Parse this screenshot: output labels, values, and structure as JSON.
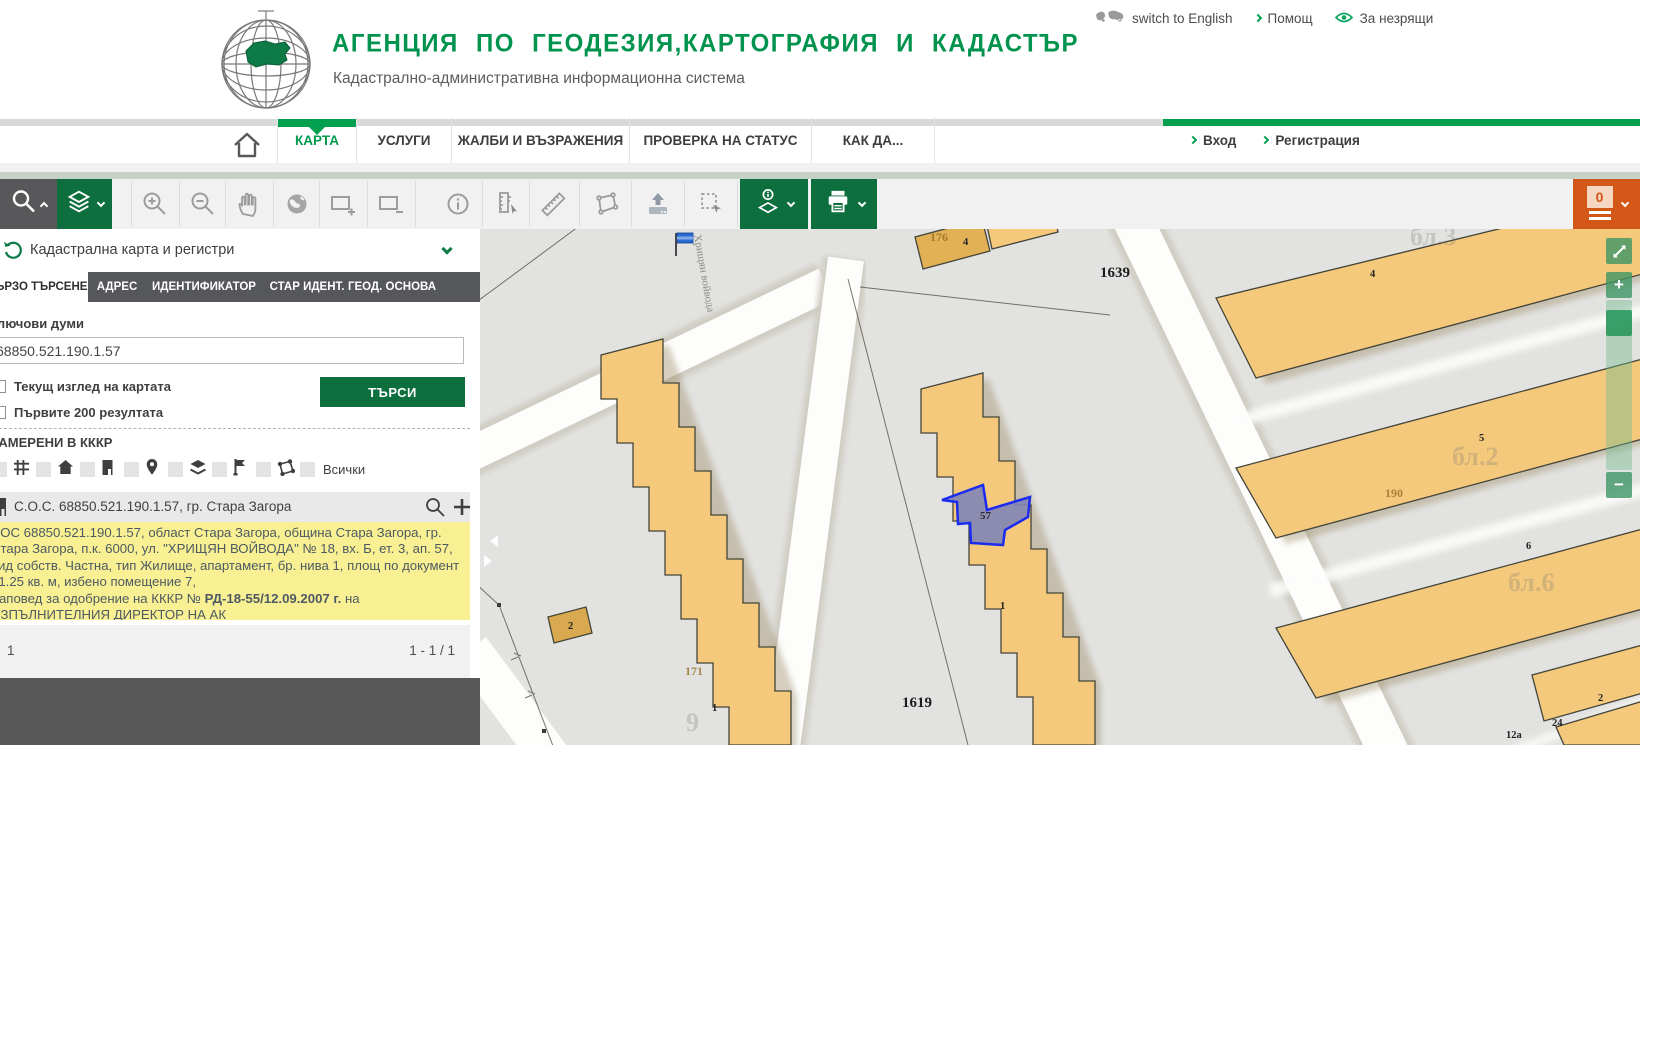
{
  "header": {
    "title": "АГЕНЦИЯ ПО ГЕОДЕЗИЯ,КАРТОГРАФИЯ И КАДАСТЪР",
    "subtitle": "Кадастрално-административна информационна система",
    "links": {
      "language": "switch to English",
      "help": "Помощ",
      "accessibility": "За незрящи"
    }
  },
  "nav": {
    "items": [
      {
        "label": "КАРТА",
        "active": true
      },
      {
        "label": "УСЛУГИ",
        "active": false
      },
      {
        "label": "ЖАЛБИ И ВЪЗРАЖЕНИЯ",
        "active": false
      },
      {
        "label": "ПРОВЕРКА НА СТАТУС",
        "active": false
      },
      {
        "label": "КАК ДА...",
        "active": false
      }
    ],
    "auth": {
      "login": "Вход",
      "register": "Регистрация"
    }
  },
  "toolbar": {
    "cart_count": "0"
  },
  "sidebar": {
    "panel_title": "Кадастрална карта и регистри",
    "tabs": [
      "БЪРЗО ТЪРСЕНЕ",
      "АДРЕС",
      "ИДЕНТИФИКАТОР",
      "СТАР ИДЕНТ.",
      "ГЕОД. ОСНОВА"
    ],
    "active_tab": "БЪРЗО ТЪРСЕНЕ",
    "keywords_label": "Ключови думи",
    "search_value": "68850.521.190.1.57",
    "option_current_view": "Текущ изглед на картата",
    "option_first_200": "Първите 200 резултата",
    "search_button": "ТЪРСИ",
    "results_header": "НАМЕРЕНИ В КККР",
    "filter_all_label": "Всички",
    "result_title": "С.О.С. 68850.521.190.1.57, гр. Стара Загора",
    "result_details_1": "СОС 68850.521.190.1.57, област Стара Загора, община Стара Загора, гр. Стара Загора, п.к. 6000, ул. \"ХРИЩЯН ВОЙВОДА\" № 18, вх. Б, ет. 3, ап. 57, вид собств. Частна, тип Жилище, апартамент, бр. нива 1, площ по документ 61.25 кв. м, избено помещение 7,",
    "result_details_2_prefix": "Заповед за одобрение на КККР № ",
    "result_details_2_bold": "РД-18-55/12.09.2007 г.",
    "result_details_2_suffix": " на ИЗПЪЛНИТЕЛНИЯ ДИРЕКТОР НА АК",
    "page_number": "1",
    "page_range": "1 - 1 / 1"
  },
  "map": {
    "street_label": "Хрищян войвода",
    "selected_parcel_label": "57",
    "zoom_in_glyph": "+",
    "zoom_out_glyph": "−",
    "labels": [
      {
        "text": "176",
        "x": 450,
        "y": 12,
        "cls": "tan-num"
      },
      {
        "text": "4",
        "x": 483,
        "y": 16,
        "cls": "bldg-num"
      },
      {
        "text": "1639",
        "x": 620,
        "y": 48,
        "cls": "parcel-num"
      },
      {
        "text": "бл.3",
        "x": 930,
        "y": 16,
        "cls": "faint"
      },
      {
        "text": "4",
        "x": 890,
        "y": 48,
        "cls": "bldg-num"
      },
      {
        "text": "5",
        "x": 999,
        "y": 212,
        "cls": "bldg-num"
      },
      {
        "text": "бл.2",
        "x": 972,
        "y": 236,
        "cls": "faint"
      },
      {
        "text": "190",
        "x": 905,
        "y": 268,
        "cls": "tan-num"
      },
      {
        "text": "6",
        "x": 1046,
        "y": 320,
        "cls": "bldg-num"
      },
      {
        "text": "бл.6",
        "x": 1028,
        "y": 362,
        "cls": "faint"
      },
      {
        "text": "1",
        "x": 520,
        "y": 380,
        "cls": "bldg-num"
      },
      {
        "text": "1619",
        "x": 422,
        "y": 478,
        "cls": "parcel-num"
      },
      {
        "text": "2",
        "x": 88,
        "y": 400,
        "cls": "bldg-num"
      },
      {
        "text": "171",
        "x": 205,
        "y": 446,
        "cls": "tan-num"
      },
      {
        "text": "1",
        "x": 232,
        "y": 482,
        "cls": "bldg-num"
      },
      {
        "text": "9",
        "x": 206,
        "y": 502,
        "cls": "faint"
      },
      {
        "text": "2",
        "x": 1118,
        "y": 472,
        "cls": "bldg-num"
      },
      {
        "text": "24",
        "x": 1072,
        "y": 497,
        "cls": "bldg-num"
      },
      {
        "text": "12а",
        "x": 1026,
        "y": 509,
        "cls": "bldg-num"
      }
    ]
  },
  "colors": {
    "brand_green": "#00934e",
    "accent_green": "#00a04f",
    "button_green": "#0d6f3d",
    "toolbar_dark": "#58585a",
    "cart_orange": "#d35716",
    "highlight_yellow": "#f8f092",
    "selection_blue": "#1b2cf0",
    "building_fill": "#f4c97c",
    "map_background": "#e2e2e0"
  }
}
